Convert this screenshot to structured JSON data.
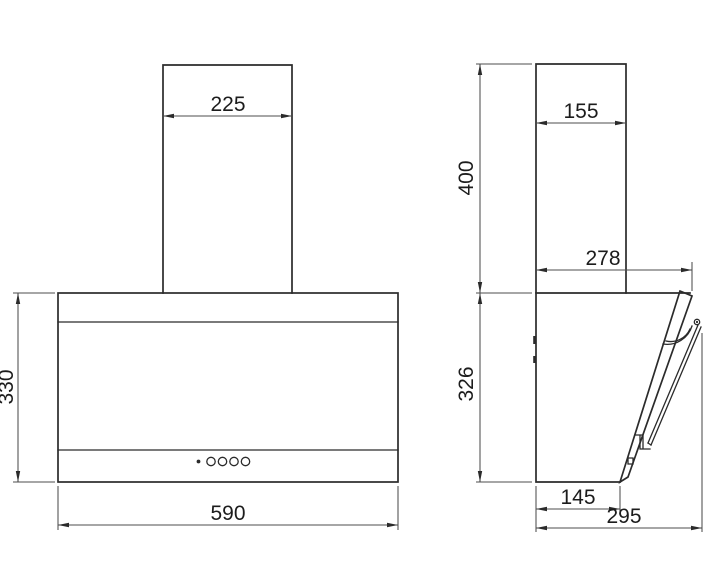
{
  "drawing": {
    "kind": "cooker-hood dimensional drawing, front and side orthographic views",
    "units_shown": "mm (implied, unlabeled)",
    "colors": {
      "line": "#2b2b2b",
      "dimension_line": "#4d4d4d",
      "text": "#1c1c1c",
      "background": "#ffffff"
    },
    "front_view": {
      "dims": {
        "chimney_width": "225",
        "body_height": "330",
        "body_width": "590"
      }
    },
    "side_view": {
      "dims": {
        "chimney_depth": "155",
        "chimney_height": "400",
        "upper_depth": "278",
        "body_height": "326",
        "bottom_depth": "145",
        "total_depth": "295"
      }
    }
  }
}
